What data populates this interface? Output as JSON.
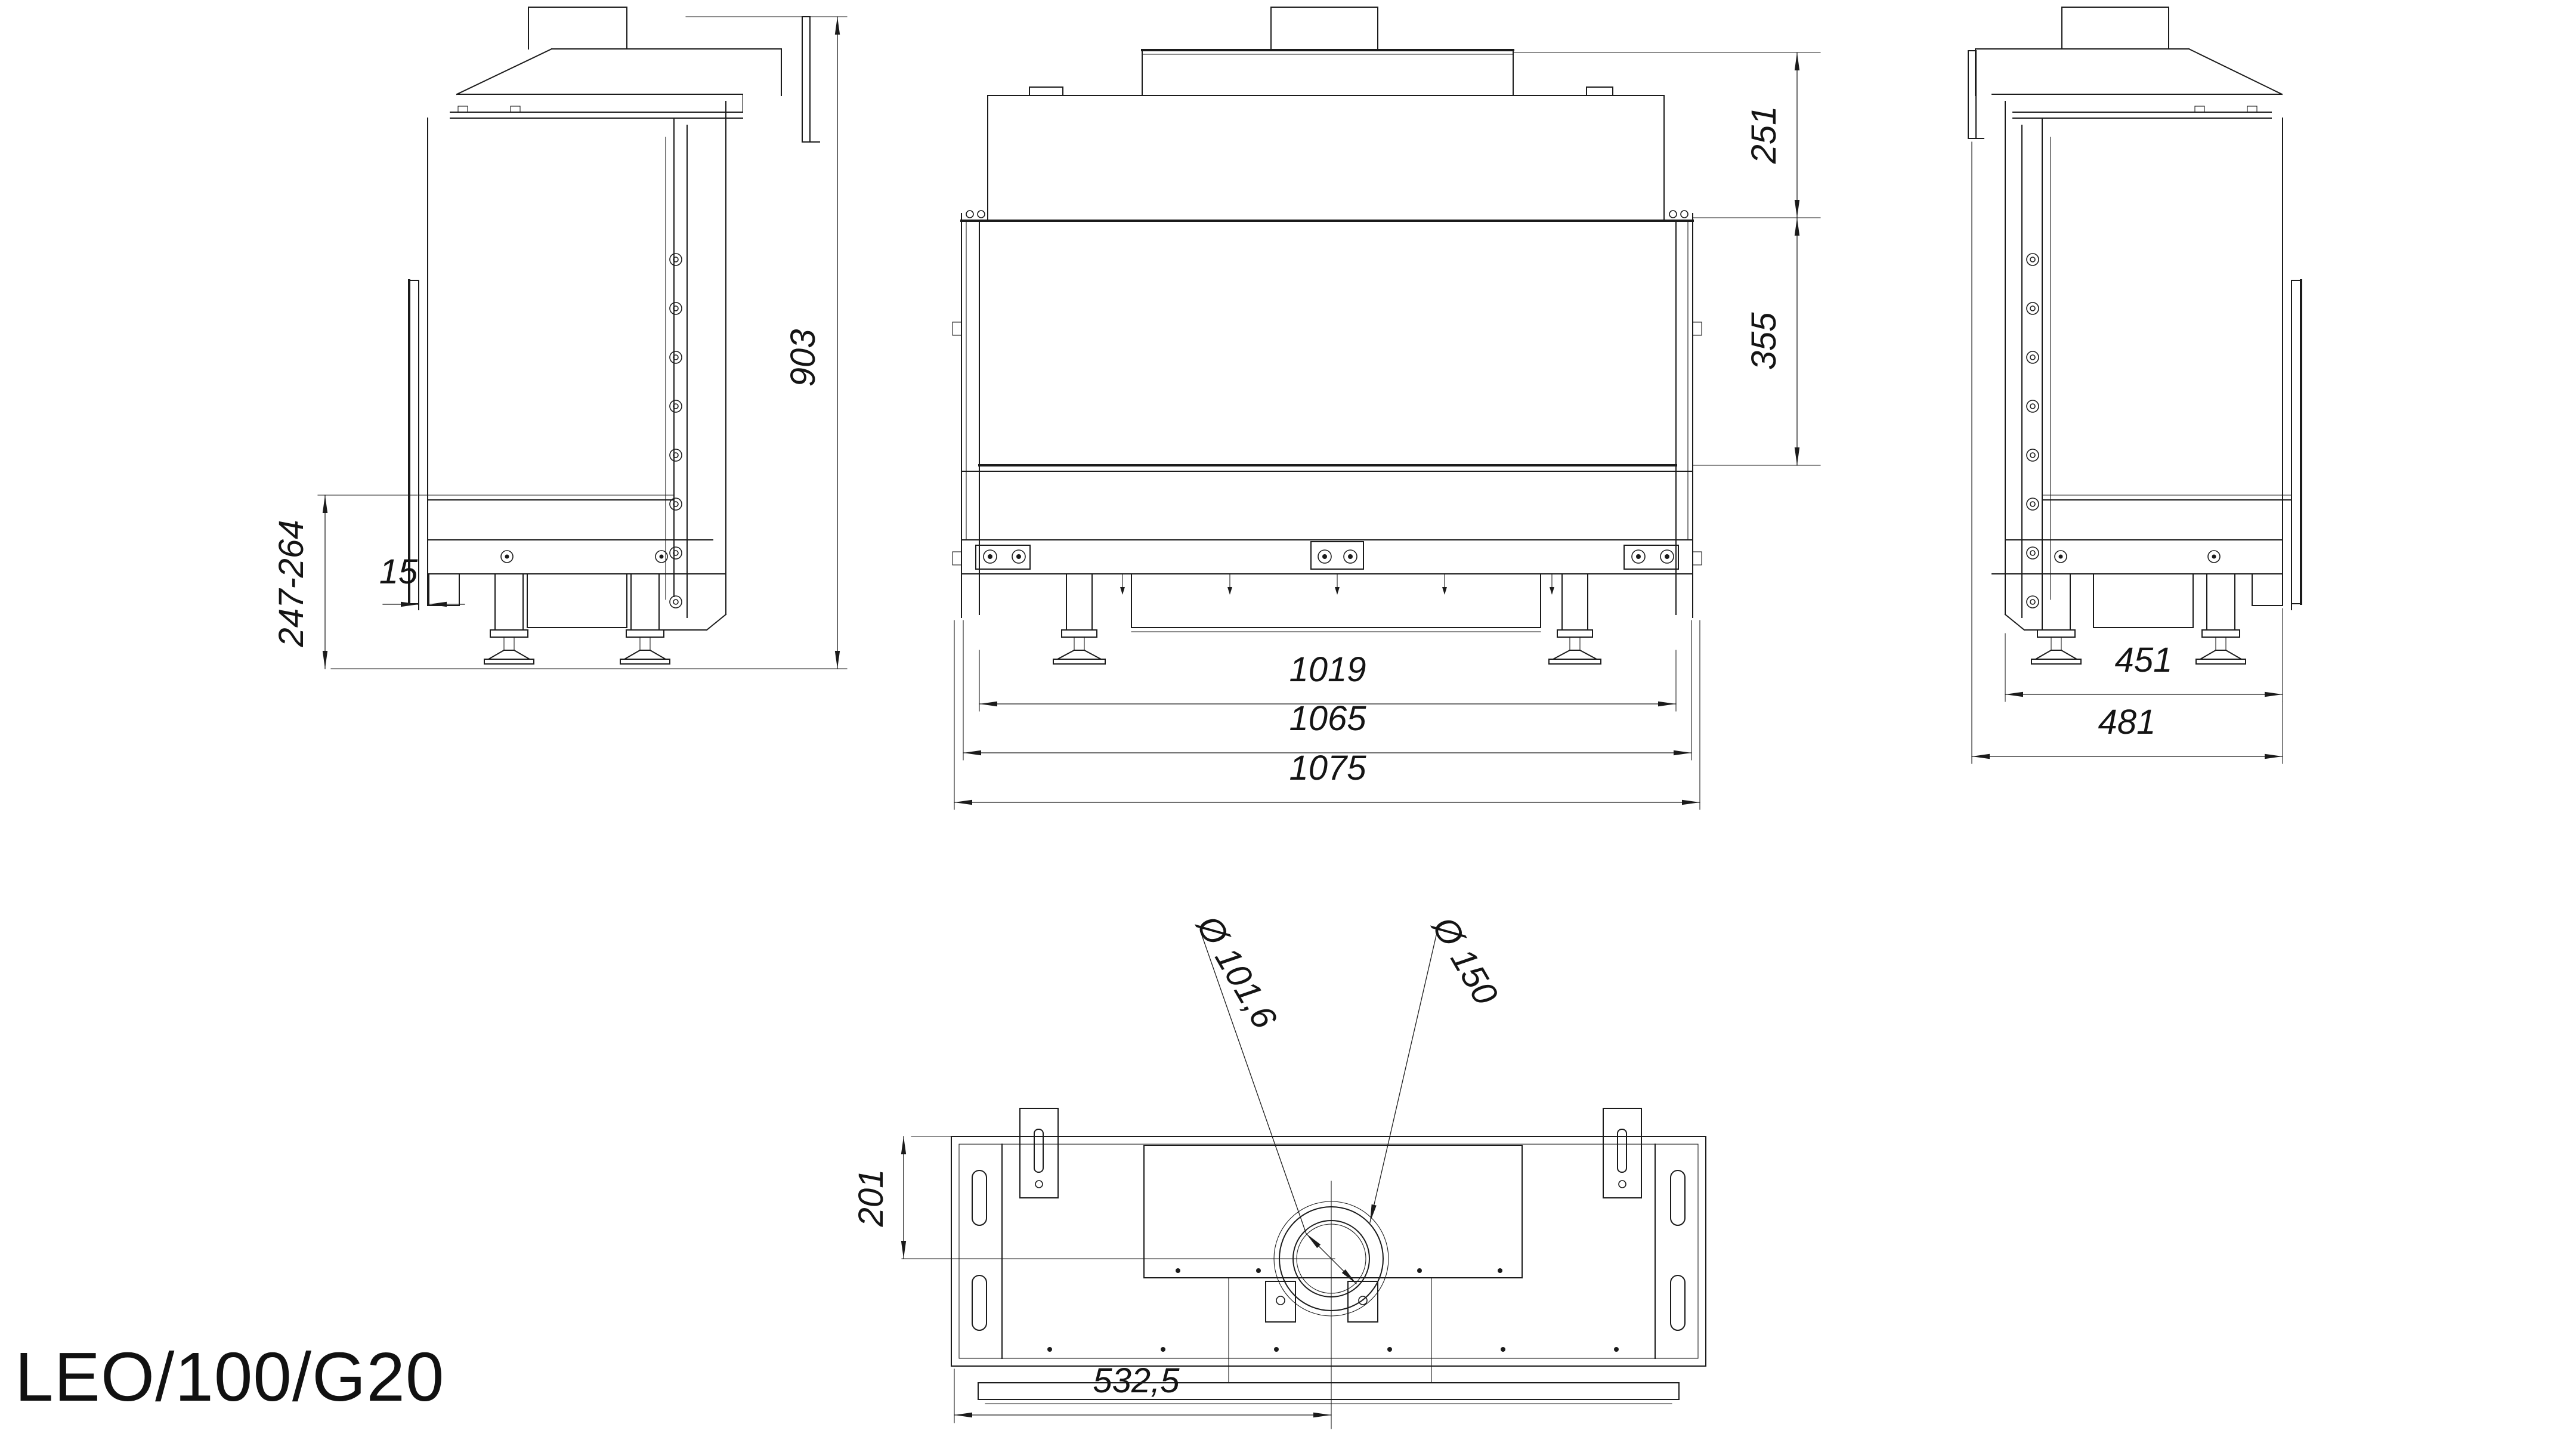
{
  "title": "LEO/100/G20",
  "views": {
    "left_side": {
      "name": "left side view",
      "dims": {
        "overall_height": "903",
        "base_height_range": "247-264",
        "glass_offset": "15"
      }
    },
    "front": {
      "name": "front view",
      "dims": {
        "hood_height": "251",
        "glass_height": "355",
        "glass_width": "1019",
        "frame_width": "1065",
        "overall_width": "1075"
      }
    },
    "right_side": {
      "name": "right side view",
      "dims": {
        "body_depth": "451",
        "overall_depth": "481"
      }
    },
    "bottom": {
      "name": "bottom view",
      "dims": {
        "flue_inner_diameter": "Ø 101,6",
        "flue_outer_diameter": "Ø 150",
        "flue_rear_offset": "201",
        "flue_side_offset": "532,5"
      }
    }
  }
}
